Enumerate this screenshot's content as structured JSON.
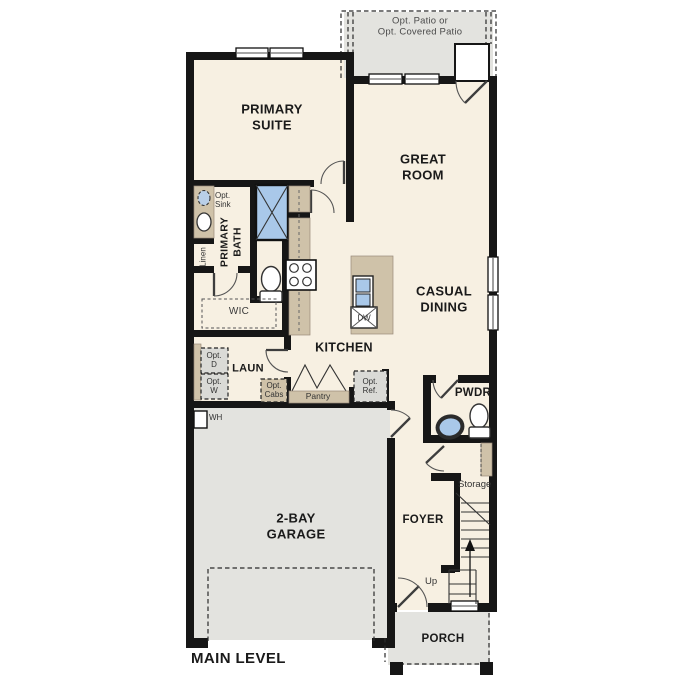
{
  "colors": {
    "wall": "#161616",
    "floor": "#f7f0e2",
    "exterior": "#e3e3df",
    "cabinet": "#cfc2a9",
    "fixture": "#a9c8e9",
    "optional": "#dadad6"
  },
  "title": "MAIN LEVEL",
  "rooms": {
    "patio": "Opt. Patio or\nOpt. Covered Patio",
    "primary_suite": "PRIMARY\nSUITE",
    "great_room": "GREAT\nROOM",
    "casual_dining": "CASUAL\nDINING",
    "kitchen": "KITCHEN",
    "primary_bath": "PRIMARY\nBATH",
    "wic": "WIC",
    "laundry": "LAUN",
    "powder": "PWDR",
    "garage": "2-BAY\nGARAGE",
    "foyer": "FOYER",
    "porch": "PORCH",
    "storage": "Storage"
  },
  "features": {
    "opt_sink": "Opt.\nSink",
    "linen": "Linen",
    "opt_dryer": "Opt.\nD",
    "opt_washer": "Opt.\nW",
    "opt_cabinets": "Opt.\nCabs",
    "pantry": "Pantry",
    "opt_refrigerator": "Opt.\nRef.",
    "dishwasher": "DW",
    "water_heater": "WH",
    "stairs_up": "Up"
  }
}
